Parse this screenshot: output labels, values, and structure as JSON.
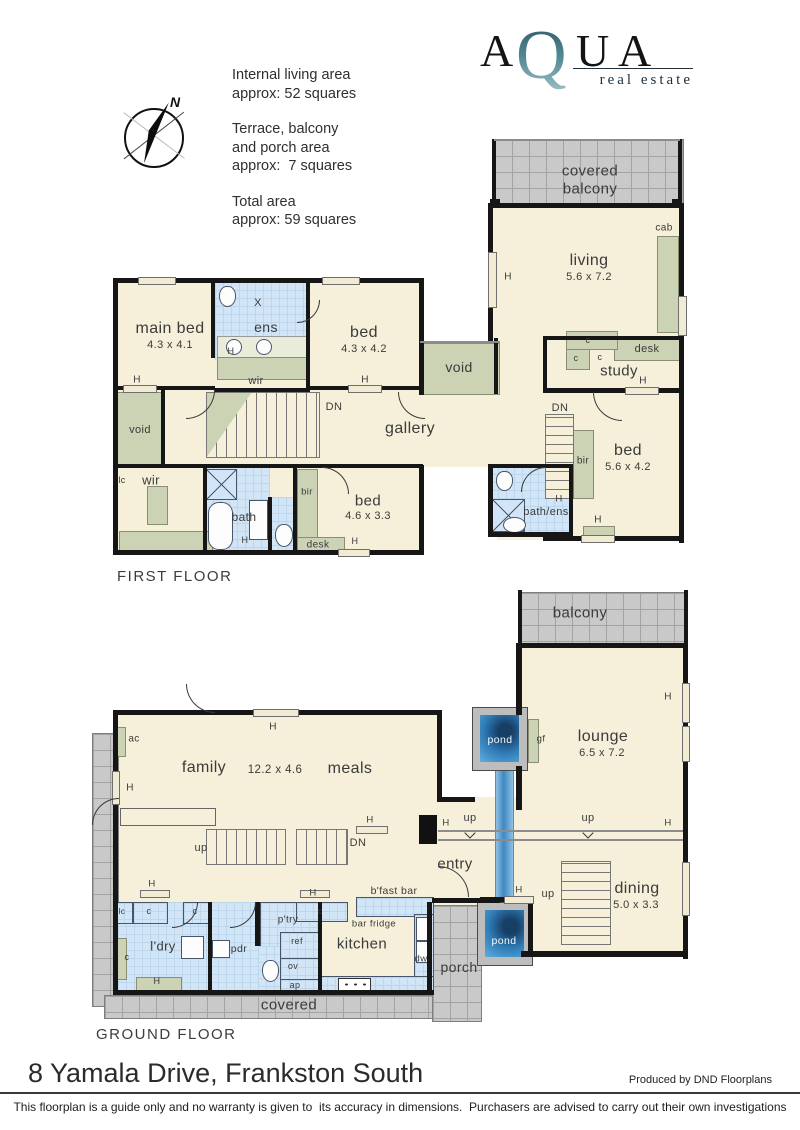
{
  "header": {
    "logo": {
      "a1": "A",
      "q": "Q",
      "u": "U",
      "a2": "A",
      "tagline": "real estate"
    },
    "compass_n": "N",
    "areas": {
      "b1l1": "Internal living area",
      "b1l2": "approx: 52 squares",
      "b2l1": "Terrace, balcony",
      "b2l2": "and porch area",
      "b2l3": "approx:  7 squares",
      "b3l1": "Total area",
      "b3l2": "approx: 59 squares"
    }
  },
  "marks": {
    "h": "H",
    "c": "c",
    "x": "X",
    "up": "up",
    "dn": "DN",
    "lc": "lc"
  },
  "ff": {
    "title": "FIRST FLOOR",
    "covered_l1": "covered",
    "covered_l2": "balcony",
    "cab": "cab",
    "living": "living",
    "living_dims": "5.6 x 7.2",
    "desk": "desk",
    "study": "study",
    "bed_r": "bed",
    "bed_r_dims": "5.6 x 4.2",
    "bir_r": "bir",
    "bath_ens": "bath/ens",
    "main_bed": "main bed",
    "main_bed_dims": "4.3 x 4.1",
    "ens": "ens",
    "wir_top": "wir",
    "bed_m": "bed",
    "bed_m_dims": "4.3 x 4.2",
    "void_c": "void",
    "gallery": "gallery",
    "void_l": "void",
    "wir_b": "wir",
    "bath": "bath",
    "bir_l": "bir",
    "bed_b": "bed",
    "bed_b_dims": "4.6 x 3.3",
    "desk_b": "desk"
  },
  "gf": {
    "title": "GROUND FLOOR",
    "balcony": "balcony",
    "lounge": "lounge",
    "lounge_dims": "6.5 x 7.2",
    "pond_t": "pond",
    "gf_mark": "gf",
    "family": "family",
    "family_dims": "12.2 x 4.6",
    "meals": "meals",
    "ac": "ac",
    "entry": "entry",
    "dining": "dining",
    "dining_dims": "5.0 x 3.3",
    "pond_b": "pond",
    "porch": "porch",
    "bfast": "b'fast bar",
    "bar_fridge": "bar fridge",
    "kitchen": "kitchen",
    "dw": "dw",
    "ref": "ref",
    "ov": "ov",
    "ap": "ap",
    "ptry": "p'try",
    "pdr": "pdr",
    "ldry": "l'dry",
    "covered": "covered"
  },
  "footer": {
    "address": "8 Yamala Drive, Frankston South",
    "credit": "Produced by DND Floorplans",
    "disclaimer": "This floorplan is a guide only and no warranty is given to  its accuracy in dimensions.  Purchasers are advised to carry out their own investigations"
  }
}
